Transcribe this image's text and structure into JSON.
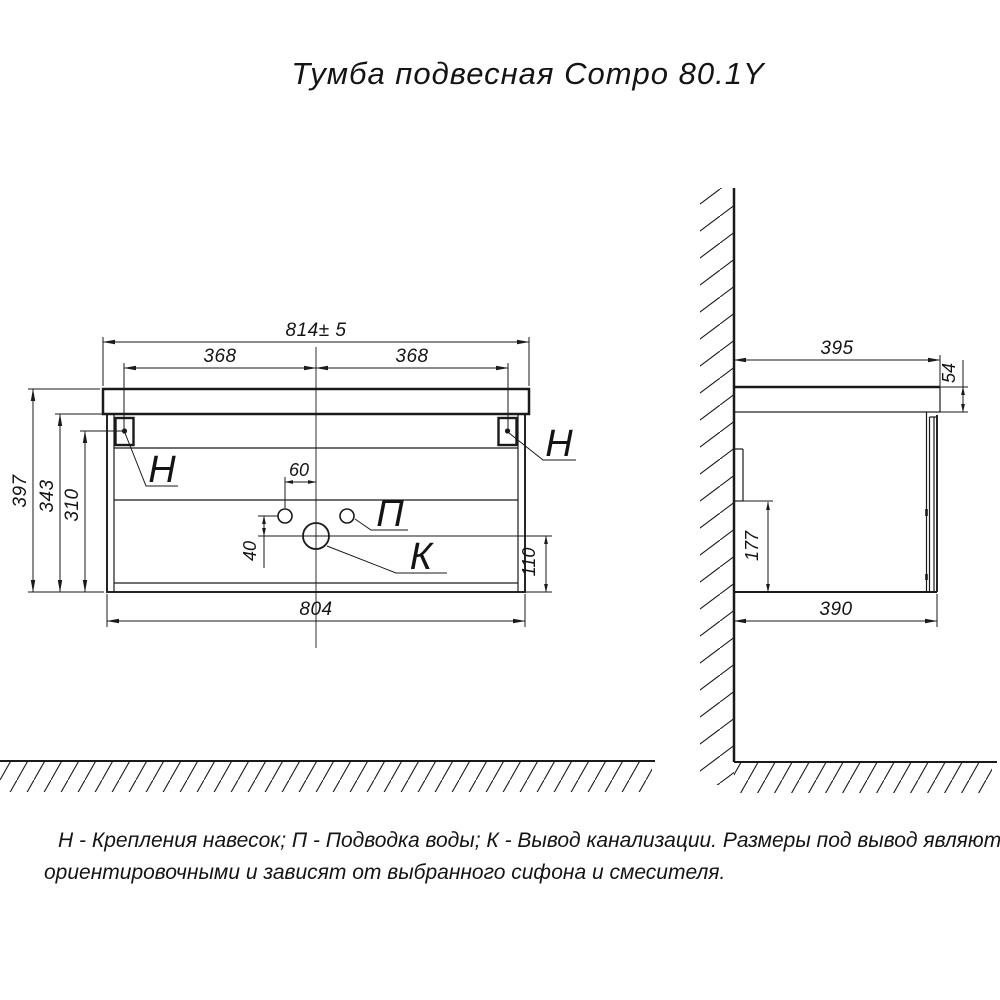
{
  "title": "Тумба подвесная Compo 80.1Y",
  "note": {
    "line1": "Н - Крепления навесок; П - Подводка воды; К - Вывод канализации. Размеры под вывод являются",
    "line2": "ориентировочными и зависят от выбранного сифона и смесителя."
  },
  "callouts": {
    "hanger_left": "Н",
    "hanger_right": "Н",
    "water_supply": "П",
    "drain_outlet": "К"
  },
  "front_view": {
    "overall_width": "814± 5",
    "hanger_offset_left": "368",
    "hanger_offset_right": "368",
    "overall_height": "397",
    "cabinet_height": "343",
    "hanger_height": "310",
    "water_holes_spacing": "60",
    "drain_drop": "40",
    "drain_bottom_height": "110",
    "cabinet_width": "804"
  },
  "side_view": {
    "overall_depth": "395",
    "top_thickness": "54",
    "hanger_bottom_height": "177",
    "cabinet_depth": "390"
  },
  "colors": {
    "line": "#1a1a1a",
    "background": "#ffffff"
  }
}
